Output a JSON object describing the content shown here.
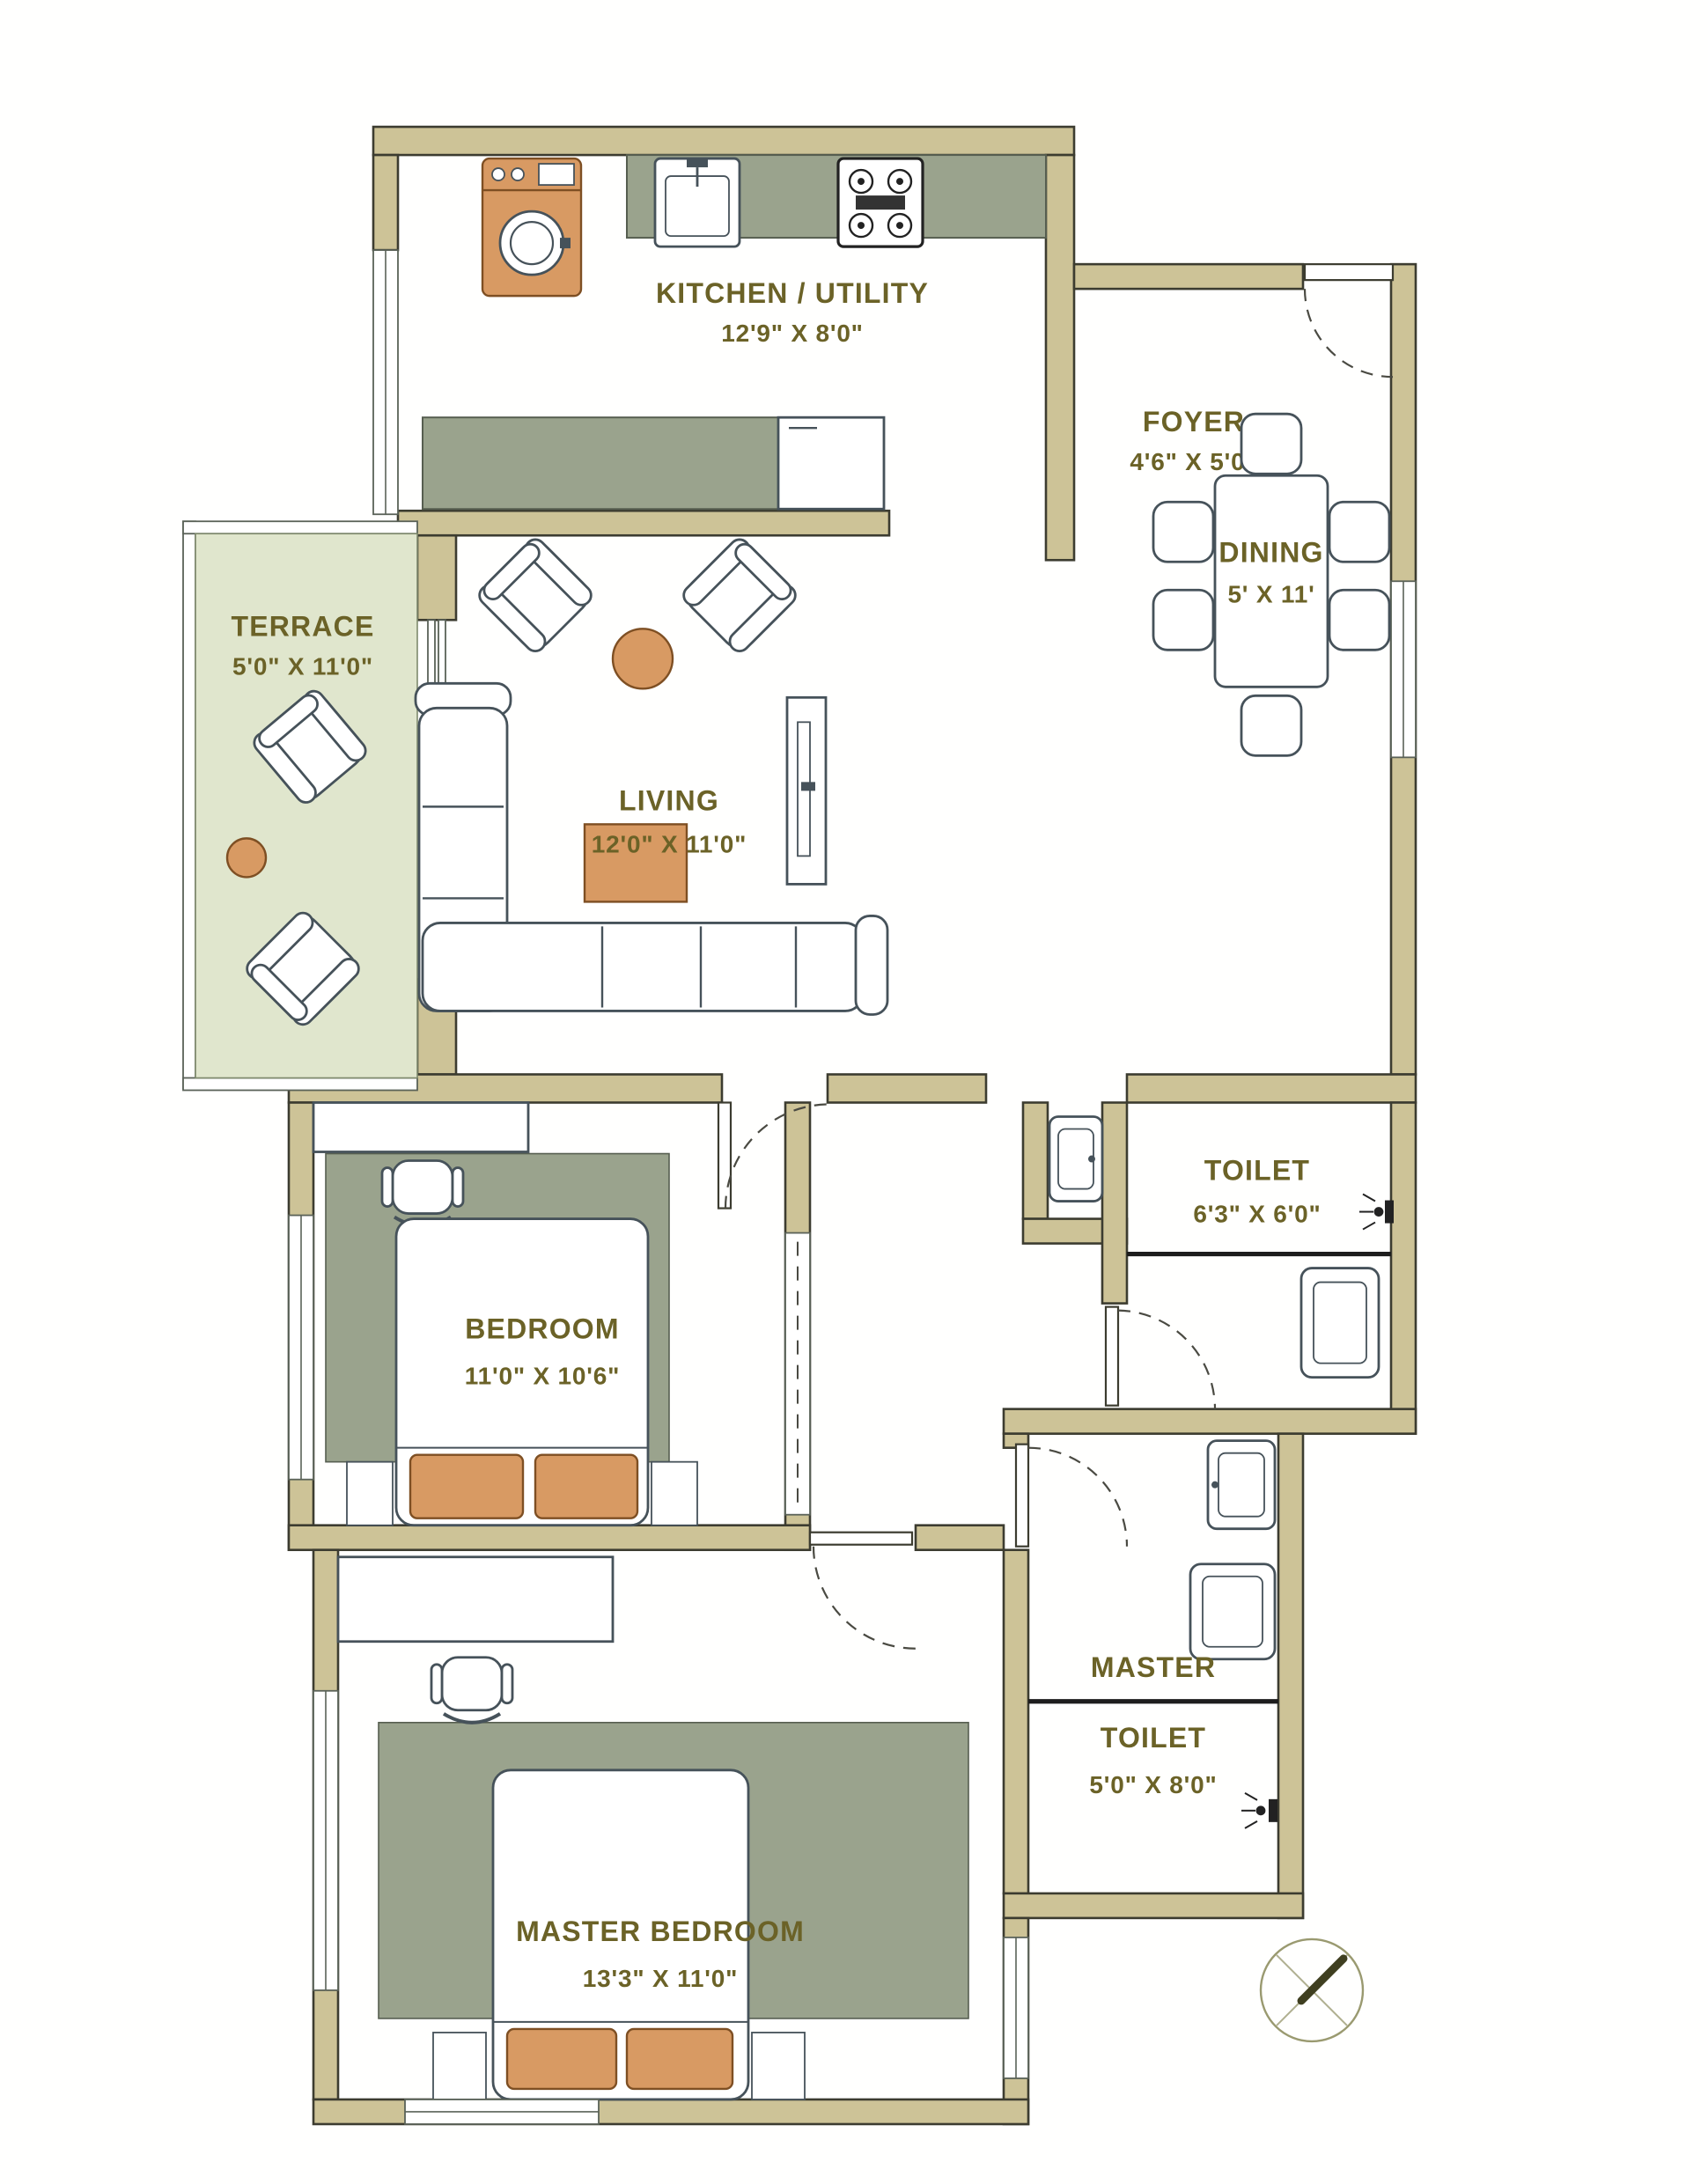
{
  "plan_title": "2BHK Apartment Floor Plan",
  "colors": {
    "wall": "#cdc397",
    "counter_and_rug": "#9aa38d",
    "terrace_floor": "#e0e6cd",
    "accent_orange": "#d89a63",
    "label_text": "#6b6227"
  },
  "rooms": {
    "kitchen": {
      "name": "KITCHEN / UTILITY",
      "size": "12'9\" X 8'0\""
    },
    "foyer": {
      "name": "FOYER",
      "size": "4'6\" X 5'0\""
    },
    "terrace": {
      "name": "TERRACE",
      "size": "5'0\" X 11'0\""
    },
    "living": {
      "name": "LIVING",
      "size": "12'0\" X 11'0\""
    },
    "dining": {
      "name": "DINING",
      "size": "5' X 11'"
    },
    "toilet": {
      "name": "TOILET",
      "size": "6'3\" X 6'0\""
    },
    "bedroom": {
      "name": "BEDROOM",
      "size": "11'0\" X 10'6\""
    },
    "master_toilet": {
      "line1": "MASTER",
      "line2": "TOILET",
      "size": "5'0\" X 8'0\""
    },
    "master_bedroom": {
      "name": "MASTER BEDROOM",
      "size": "13'3\" X 11'0\""
    }
  }
}
